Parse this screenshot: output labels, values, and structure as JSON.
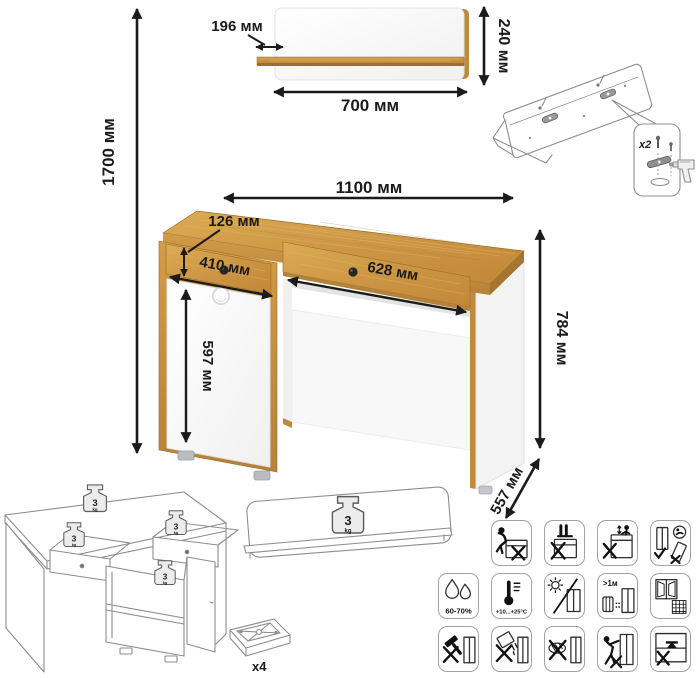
{
  "dimensions": {
    "total_height": "1700 мм",
    "shelf": {
      "depth": "196 мм",
      "width": "700 мм",
      "height": "240 мм"
    },
    "desk": {
      "width": "1100 мм",
      "drawer_height": "126 мм",
      "left_drawer_width": "410 мм",
      "right_drawer_width": "628 мм",
      "door_height": "597 мм",
      "height": "784 мм",
      "depth": "557 мм"
    }
  },
  "hardware": {
    "wall_fittings_count": "x2",
    "feet_count": "x4"
  },
  "max_load": {
    "value": "3",
    "unit": "kg"
  },
  "care": {
    "humidity_range": "60-70%",
    "temperature_range": "+10...+25°C",
    "heater_distance": ">1м"
  },
  "care_icons": {
    "row1": [
      "no-sitting-icon",
      "no-standing-icon",
      "no-climbing-icon",
      "carry-upright-no-drag-icon"
    ],
    "row2": [
      "humidity-icon",
      "temperature-icon",
      "no-direct-sunlight-icon",
      "distance-from-heater-icon",
      "ventilated-room-icon"
    ],
    "row3": [
      "no-striking-tools-icon",
      "no-spilling-liquids-icon",
      "no-abrasive-cleaners-icon",
      "no-pushing-icon",
      "no-heavy-items-inside-icon"
    ]
  },
  "colors": {
    "oak": "#c89140",
    "oak_dark": "#a5772e",
    "panel_white": "#ffffff",
    "dimension_ink": "#1b1b1b",
    "drawing_line": "#8d8d8d"
  }
}
